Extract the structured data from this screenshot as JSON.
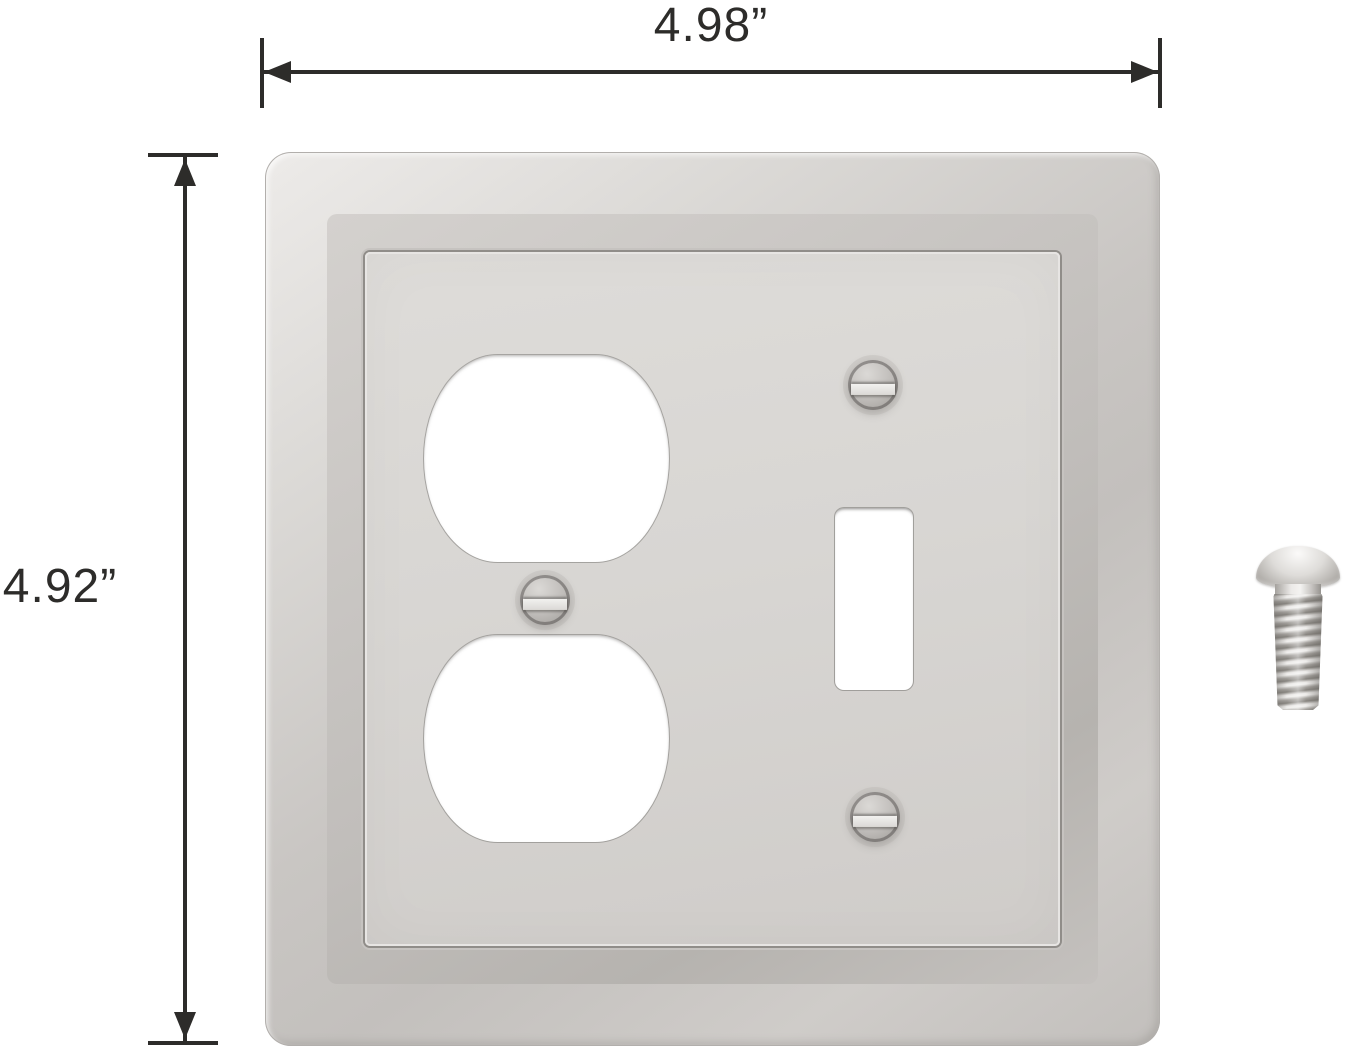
{
  "dimension_labels": {
    "width": "4.98”",
    "height": "4.92”"
  },
  "colors": {
    "background": "#ffffff",
    "dimension_line": "#2d2c2a",
    "plate_highlight": "#edebe9",
    "plate_mid": "#c9c6c3",
    "plate_shadow": "#96938f",
    "panel_face": "#d8d6d3",
    "opening_fill": "#ffffff"
  },
  "graphics": {
    "plate": "brushed-nickel-two-gang-wall-plate",
    "openings": [
      "duplex-outlet-top",
      "duplex-outlet-bottom",
      "toggle-switch"
    ],
    "plate_screws": [
      "duplex-center-screw",
      "toggle-top-screw",
      "toggle-bottom-screw"
    ],
    "hardware": "loose-mounting-screw"
  }
}
